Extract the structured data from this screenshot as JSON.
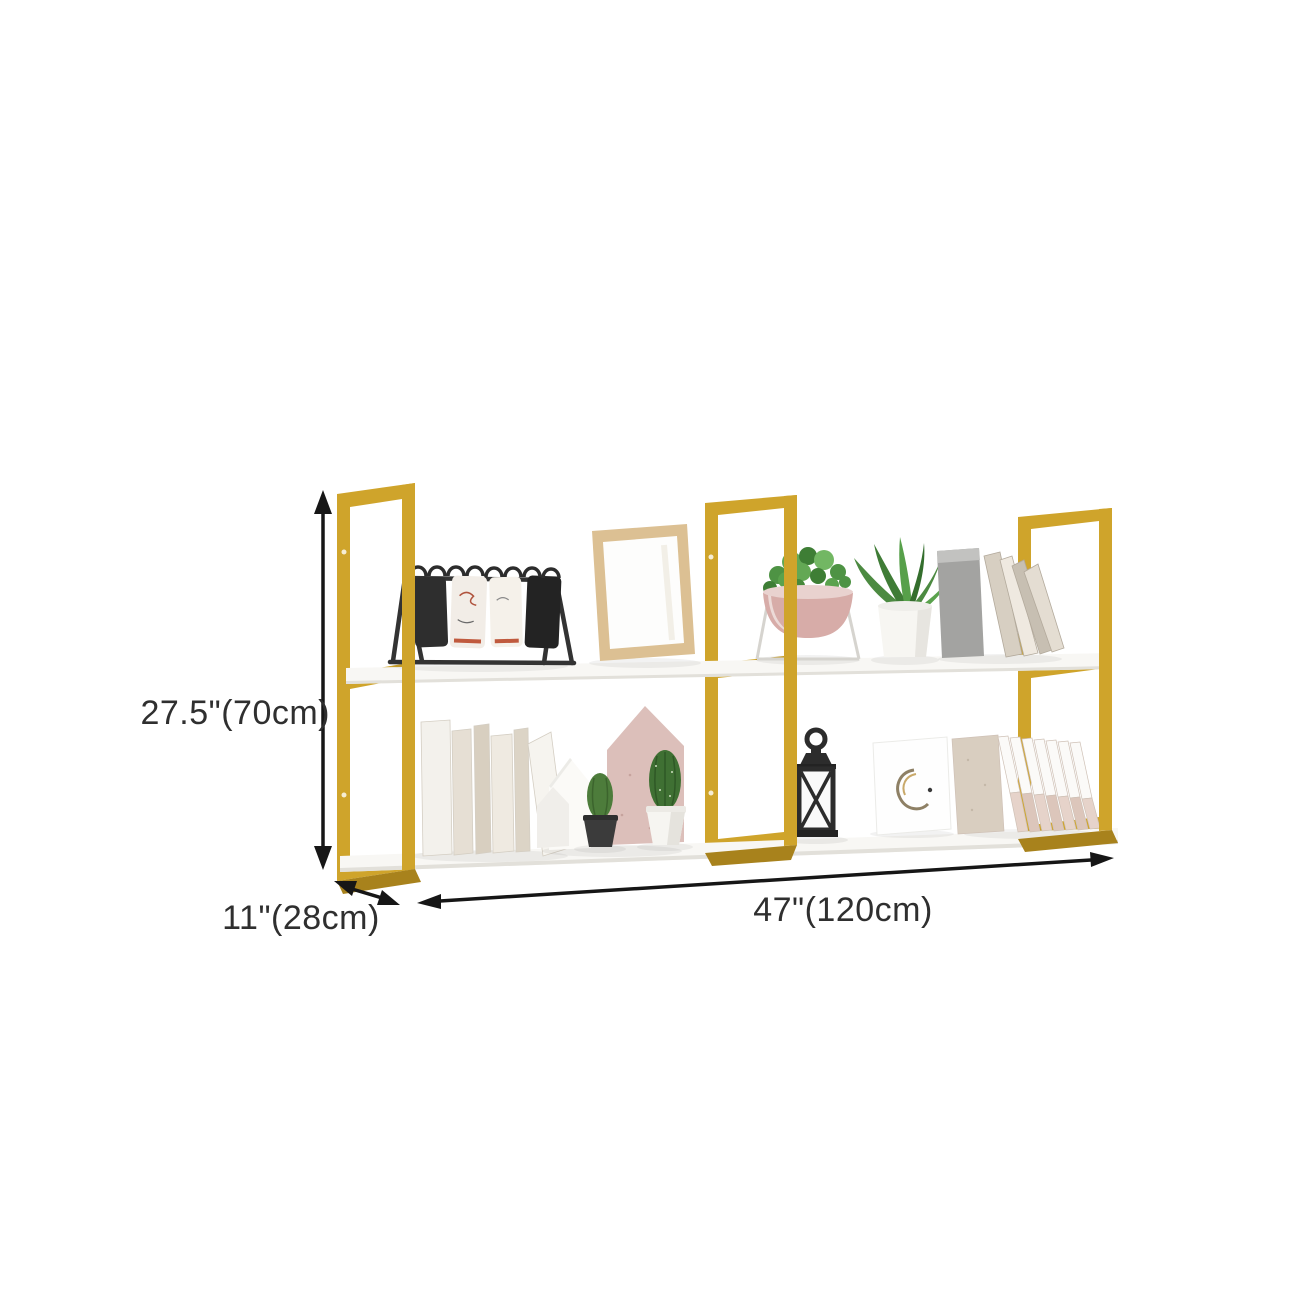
{
  "scene": {
    "kind": "furniture-dimension-diagram",
    "product": "two-tier-gold-frame-wall-shelf"
  },
  "dimensions": {
    "height_label": "27.5\"(70cm)",
    "depth_label": "11\"(28cm)",
    "width_label": "47\"(120cm)"
  },
  "colors": {
    "background": "#ffffff",
    "frame_gold": "#cfa42b",
    "frame_gold_dark": "#a8821c",
    "shelf_white": "#f8f7f4",
    "shelf_shadow": "#e2e0da",
    "dimension_line": "#161616",
    "label_text": "#2f2f2f"
  },
  "decor": {
    "top_shelf_items": [
      "flip-card-calendar",
      "wood-picture-frame",
      "bowl-planter",
      "aloe-plant-pot",
      "grey-bookend",
      "leaning-magazines"
    ],
    "bottom_shelf_items": [
      "standing-books",
      "white-house-bookends",
      "pink-house-ornament",
      "cactus-black-pot",
      "cactus-white-pot",
      "candle-lantern",
      "art-canvas",
      "leaning-file-folders"
    ]
  }
}
